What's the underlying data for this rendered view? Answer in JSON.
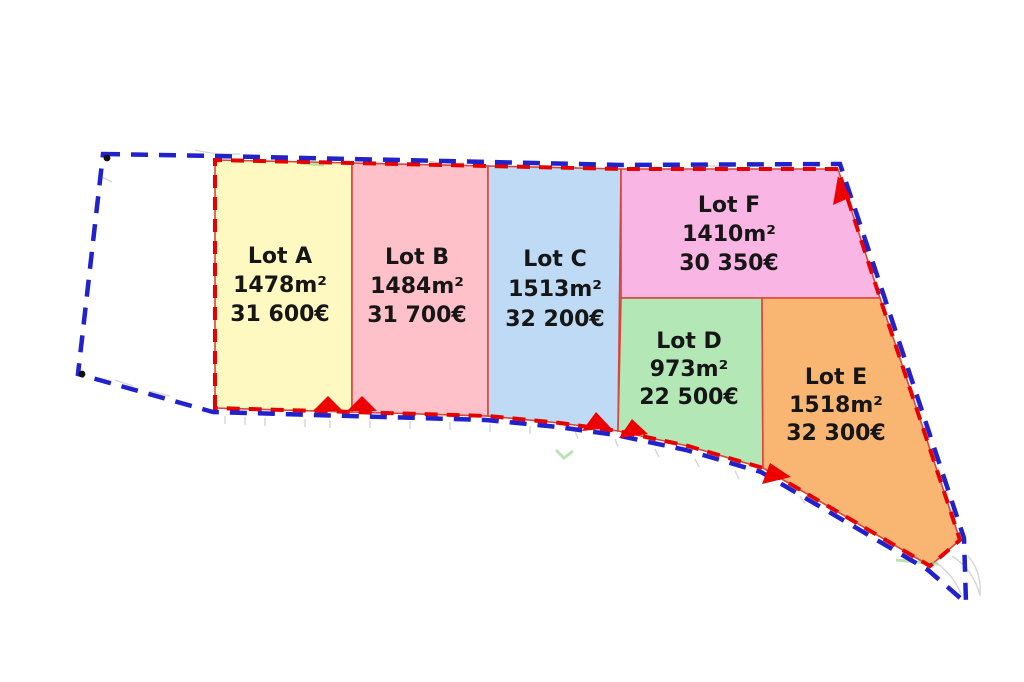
{
  "plan": {
    "type": "land-subdivision-plan",
    "lots": [
      {
        "id": "A",
        "name": "Lot A",
        "area": "1478m²",
        "price": "31 600€",
        "fill": "#fdf9c1"
      },
      {
        "id": "B",
        "name": "Lot B",
        "area": "1484m²",
        "price": "31 700€",
        "fill": "#fec1ca"
      },
      {
        "id": "C",
        "name": "Lot C",
        "area": "1513m²",
        "price": "32 200€",
        "fill": "#bedaf4"
      },
      {
        "id": "D",
        "name": "Lot D",
        "area": "973m²",
        "price": "22 500€",
        "fill": "#b3e7b6"
      },
      {
        "id": "E",
        "name": "Lot E",
        "area": "1518m²",
        "price": "32 300€",
        "fill": "#f8b672"
      },
      {
        "id": "F",
        "name": "Lot F",
        "area": "1410m²",
        "price": "30 350€",
        "fill": "#f9b5e3"
      }
    ],
    "unlabeled_parcel_fill": "#ffffff",
    "colors": {
      "outer_boundary_blue": "#2121cd",
      "lot_perimeter_red": "#e60000",
      "lot_divider_red": "#d8453a",
      "access_arrow_red": "#ee0000",
      "label_text": "#161616",
      "background": "#ffffff"
    },
    "icons": {
      "access_arrow": "red-triangle-marker"
    }
  }
}
